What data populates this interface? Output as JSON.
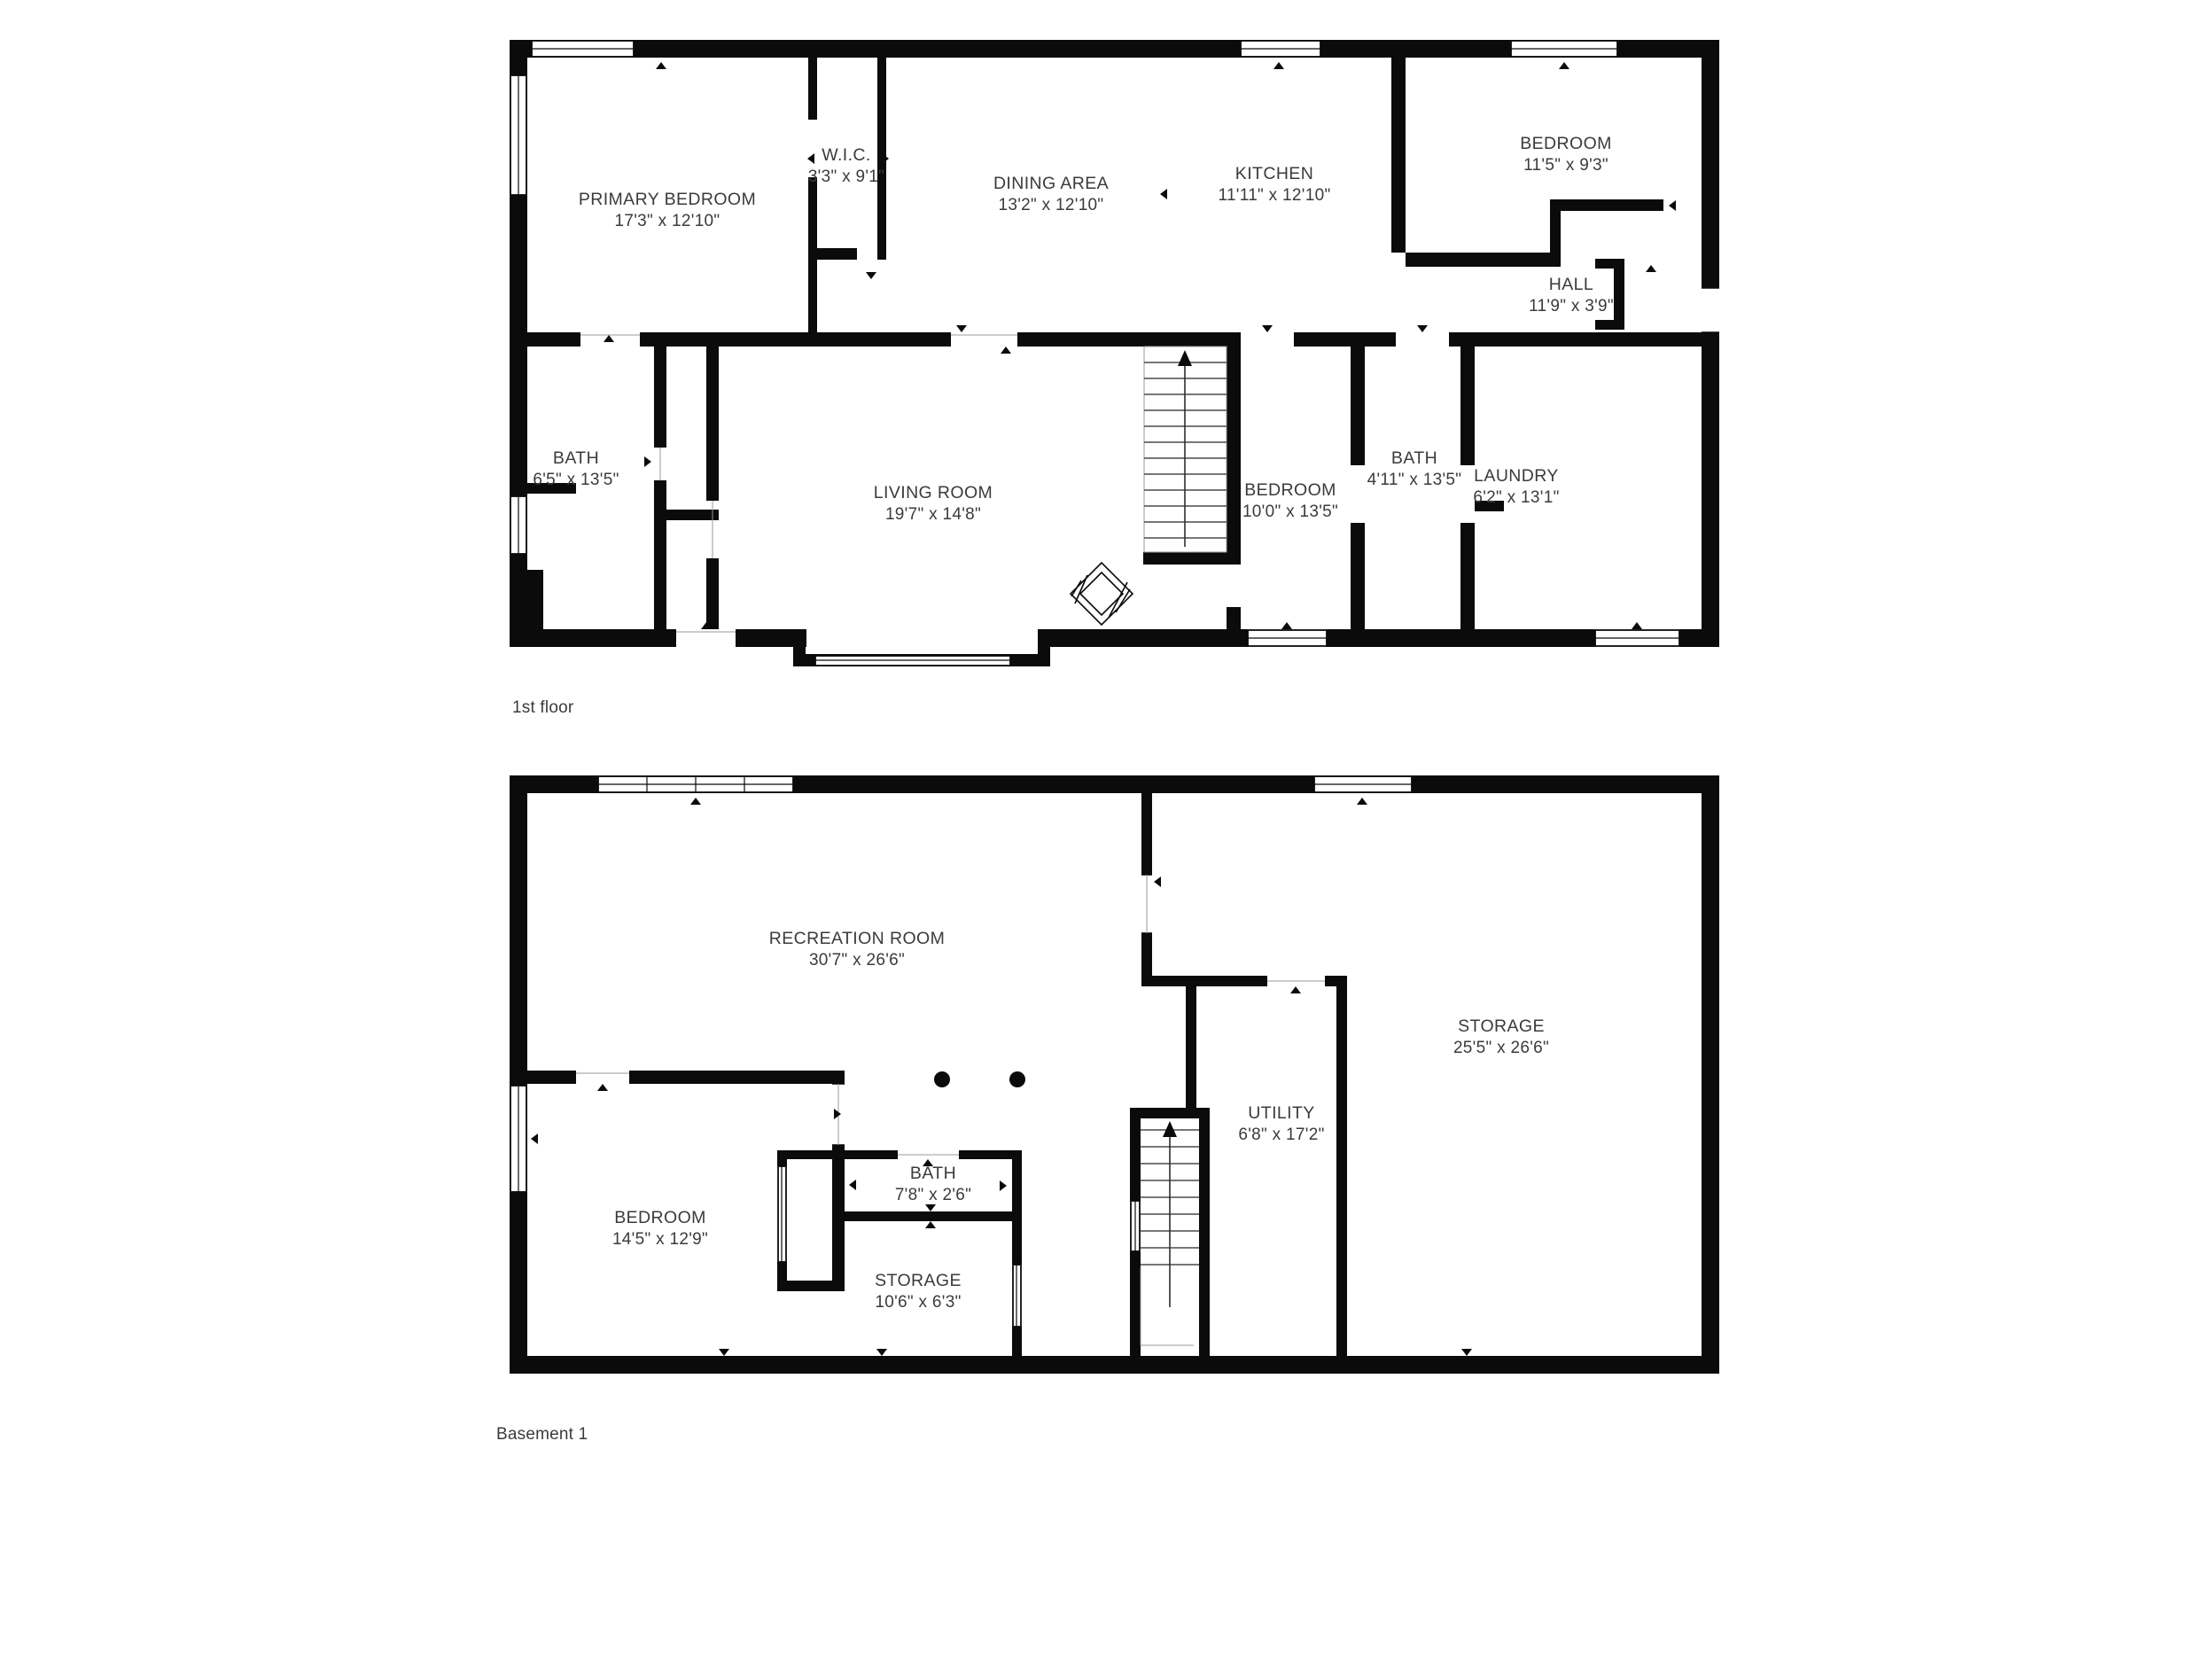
{
  "colors": {
    "wall": "#0b0b0b",
    "text": "#3b3b3b",
    "background": "#ffffff"
  },
  "floors": [
    {
      "caption": "1st floor",
      "rooms": [
        {
          "name": "PRIMARY BEDROOM",
          "dims": "17'3\" x 12'10\""
        },
        {
          "name": "W.I.C.",
          "dims": "3'3\" x 9'1\""
        },
        {
          "name": "DINING AREA",
          "dims": "13'2\" x 12'10\""
        },
        {
          "name": "KITCHEN",
          "dims": "11'11\" x 12'10\""
        },
        {
          "name": "BEDROOM",
          "dims": "11'5\" x 9'3\""
        },
        {
          "name": "HALL",
          "dims": "11'9\" x 3'9\""
        },
        {
          "name": "BATH",
          "dims": "6'5\" x 13'5\""
        },
        {
          "name": "LIVING ROOM",
          "dims": "19'7\" x 14'8\""
        },
        {
          "name": "BEDROOM",
          "dims": "10'0\" x 13'5\""
        },
        {
          "name": "BATH",
          "dims": "4'11\" x 13'5\""
        },
        {
          "name": "LAUNDRY",
          "dims": "6'2\" x 13'1\""
        }
      ]
    },
    {
      "caption": "Basement 1",
      "rooms": [
        {
          "name": "RECREATION ROOM",
          "dims": "30'7\" x 26'6\""
        },
        {
          "name": "STORAGE",
          "dims": "25'5\" x 26'6\""
        },
        {
          "name": "UTILITY",
          "dims": "6'8\" x 17'2\""
        },
        {
          "name": "BEDROOM",
          "dims": "14'5\" x 12'9\""
        },
        {
          "name": "BATH",
          "dims": "7'8\" x 2'6\""
        },
        {
          "name": "STORAGE",
          "dims": "10'6\" x 6'3\""
        }
      ]
    }
  ]
}
